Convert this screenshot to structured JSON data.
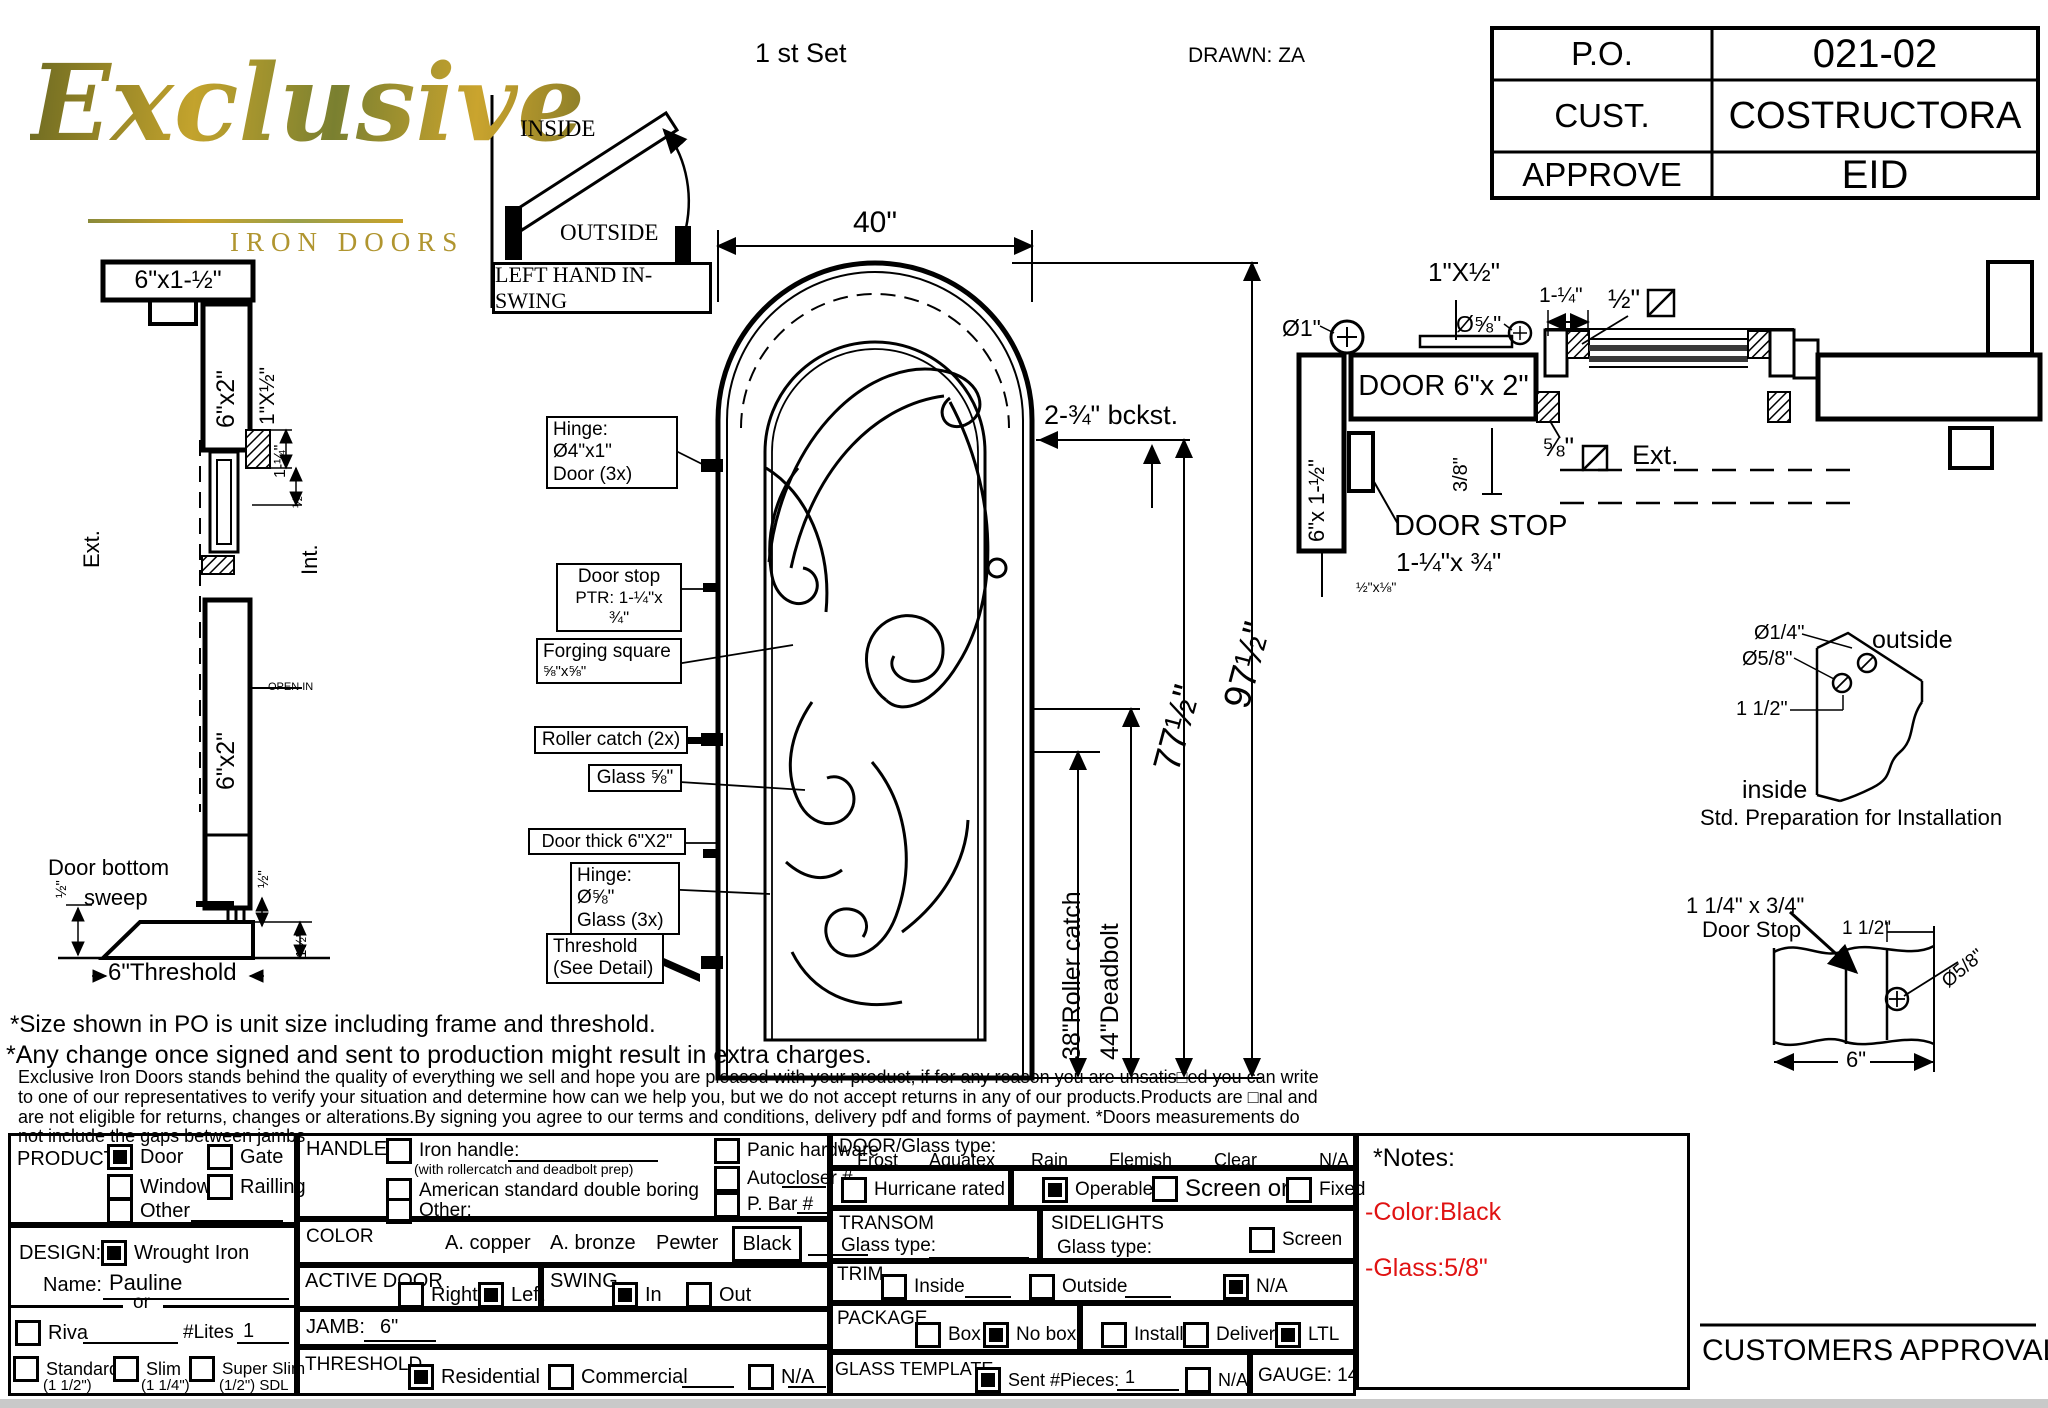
{
  "colors": {
    "line": "#000000",
    "logo_gold": "#a6902f",
    "note_red": "#e01212",
    "paper": "#ffffff"
  },
  "header": {
    "logo_script": "Exclusive",
    "logo_sub": "IRON DOORS",
    "set_label": "1 st Set",
    "drawn_by": "DRAWN: ZA",
    "swing_diagram": {
      "inside": "INSIDE",
      "outside": "OUTSIDE",
      "caption": "LEFT HAND IN-SWING"
    },
    "title_block": {
      "rows": [
        {
          "label": "P.O.",
          "value": "021-02"
        },
        {
          "label": "CUST.",
          "value": "COSTRUCTORA"
        },
        {
          "label": "APPROVE",
          "value": "EID"
        }
      ]
    }
  },
  "jamb_section": {
    "header_size": "6\"x1-½\"",
    "jamb_size": "6\"x2\"",
    "trim_size": "1\"X½\"",
    "dim_1q": "1-¼\"",
    "dim_half_a": "½\"",
    "ext": "Ext.",
    "int": "Int.",
    "open_in": "OPEN IN",
    "leaf_size": "6\"x2\"",
    "sweep_line1": "Door bottom",
    "sweep_line2": "sweep",
    "dim_half_b": "½\"",
    "dim_half_c": "½\"",
    "dim_1half": "1½\"",
    "threshold": "6\"Threshold"
  },
  "elevation": {
    "width_dim": "40\"",
    "callouts": {
      "hinge1a": "Hinge: Ø4\"x1\"",
      "hinge1b": "Door (3x)",
      "doorstop1": "Door stop",
      "doorstop2": "PTR: 1-¼\"x ¾\"",
      "forging1": "Forging square",
      "forging2": "⅝\"x⅝\"",
      "roller": "Roller catch  (2x)",
      "glass": "Glass ⅝\"",
      "doorthick": "Door thick 6\"X2\"",
      "hinge2a": "Hinge: Ø⅝\"",
      "hinge2b": "Glass (3x)",
      "threshold1": "Threshold",
      "threshold2": "(See Detail)"
    },
    "bckst": "2-¾\"  bckst.",
    "dim_roller": "38\"Roller catch",
    "dim_deadbolt": "44\"Deadbolt",
    "dim_77": "77½\"",
    "dim_97": "97½\""
  },
  "plan_section": {
    "trim": "1\"X½\"",
    "dia58": "Ø⅝\"",
    "dia1": "Ø1\"",
    "dim114": "1-¼\"",
    "dim12": "½\"",
    "door_label": "DOOR 6\"x 2\"",
    "jamb_label": "6\"x 1-½\"",
    "dim38": "3/8\"",
    "dim58": "⅝\"",
    "ext": "Ext.",
    "door_stop": "DOOR STOP",
    "stop_size": "1-¼\"x ¾\"",
    "small_size": "½\"x⅛\""
  },
  "std_prep": {
    "dia14": "Ø1/4\"",
    "dia58": "Ø5/8\"",
    "dim112": "1 1/2\"",
    "outside": "outside",
    "inside": "inside",
    "caption": "Std. Preparation for Installation"
  },
  "stop_detail": {
    "size": "1 1/4\" x 3/4\"",
    "name": "Door Stop",
    "dim112": "1 1/2\"",
    "dia58": "Ø5/8\"",
    "width": "6\""
  },
  "notes": {
    "line1": "*Size shown in PO is unit size including frame and threshold.",
    "line2": "*Any change once signed and sent to production might result in extra charges.",
    "paragraph": "Exclusive Iron Doors stands behind the quality of everything we sell and hope you are pleased with your product, if for any reason you are unsatis□ed you can write to one of our representatives to verify your situation and determine how can we help you, but we do not accept returns in any of our products.Products are □nal and are not eligible for returns, changes or alterations.By signing you agree to our terms and conditions, delivery pdf and forms of payment. *Doors measurements do not include the gaps between jambs"
  },
  "form": {
    "product": {
      "label": "PRODUCT:",
      "options": [
        {
          "label": "Door",
          "checked": true
        },
        {
          "label": "Gate",
          "checked": false
        },
        {
          "label": "Window",
          "checked": false
        },
        {
          "label": "Railling",
          "checked": false
        },
        {
          "label": "Other",
          "checked": false
        }
      ]
    },
    "design": {
      "label": "DESIGN:",
      "wrought": {
        "label": "Wrought Iron",
        "checked": true
      },
      "name_label": "Name:",
      "name_value": "Pauline",
      "or": "or",
      "riva": {
        "label": "Riva",
        "checked": false
      },
      "lites_label": "#Lites",
      "lites_value": "1",
      "sizes": [
        {
          "label": "Standard",
          "sub": "(1 1/2\")",
          "checked": false
        },
        {
          "label": "Slim",
          "sub": "(1 1/4\")",
          "checked": false
        },
        {
          "label": "Super Slim",
          "sub": "(1/2\") SDL",
          "checked": false
        }
      ]
    },
    "handle": {
      "label": "HANDLE",
      "iron": {
        "label": "Iron handle:",
        "checked": false
      },
      "iron_sub": "(with rollercatch and deadbolt prep)",
      "asdb": {
        "label": "American standard double boring",
        "checked": false
      },
      "other": {
        "label": "Other:",
        "checked": false
      },
      "panic": {
        "label": "Panic hardware",
        "checked": false
      },
      "autocloser": {
        "label": "Autocloser #",
        "checked": false
      },
      "pbar": {
        "label": "P. Bar #",
        "checked": false
      }
    },
    "color": {
      "label": "COLOR",
      "opt1": "A. copper",
      "opt2": "A. bronze",
      "opt3": "Pewter",
      "selected": "Black"
    },
    "active_door": {
      "label": "ACTIVE DOOR",
      "right": {
        "label": "Right",
        "checked": false
      },
      "left": {
        "label": "Left",
        "checked": true
      }
    },
    "swing": {
      "label": "SWING",
      "in": {
        "label": "In",
        "checked": true
      },
      "out": {
        "label": "Out",
        "checked": false
      }
    },
    "jamb": {
      "label": "JAMB:",
      "value": "6\""
    },
    "threshold": {
      "label": "THRESHOLD",
      "residential": {
        "label": "Residential",
        "checked": true
      },
      "commercial": {
        "label": "Commercial",
        "checked": false
      },
      "na": {
        "label": "N/A",
        "checked": false
      }
    },
    "door_glass": {
      "label": "DOOR/Glass type:",
      "types": [
        "Frost",
        "Aquatex",
        "Rain",
        "Flemish",
        "Clear",
        "N/A"
      ]
    },
    "hurricane": {
      "label": "Hurricane rated",
      "checked": false
    },
    "operable": {
      "label": "Operable",
      "checked": true
    },
    "screen_or": {
      "label": "Screen or",
      "checked": false
    },
    "fixed": {
      "label": "Fixed",
      "checked": false
    },
    "transom": {
      "label": "TRANSOM",
      "glass_type": "Glass type:"
    },
    "sidelights": {
      "label": "SIDELIGHTS",
      "glass_type": "Glass type:",
      "screen": {
        "label": "Screen",
        "checked": false
      }
    },
    "trim": {
      "label": "TRIM",
      "inside": {
        "label": "Inside",
        "checked": false
      },
      "outside": {
        "label": "Outside",
        "checked": false
      },
      "na": {
        "label": "N/A",
        "checked": true
      }
    },
    "package": {
      "label": "PACKAGE",
      "box": {
        "label": "Box",
        "checked": false
      },
      "nobox": {
        "label": "No box",
        "checked": true
      },
      "install": {
        "label": "Install",
        "checked": false
      },
      "delivery": {
        "label": "Delivery",
        "checked": false
      },
      "ltl": {
        "label": "LTL",
        "checked": true
      }
    },
    "glass_template": {
      "label": "GLASS TEMPLATE",
      "sent": {
        "label": "Sent #Pieces:",
        "checked": true
      },
      "pieces": "1",
      "na": {
        "label": "N/A",
        "checked": false
      }
    },
    "gauge": "GAUGE: 14"
  },
  "notes_box": {
    "title": "*Notes:",
    "color_note": "-Color:Black",
    "glass_note": "-Glass:5/8\""
  },
  "approval": "CUSTOMERS APPROVAL"
}
